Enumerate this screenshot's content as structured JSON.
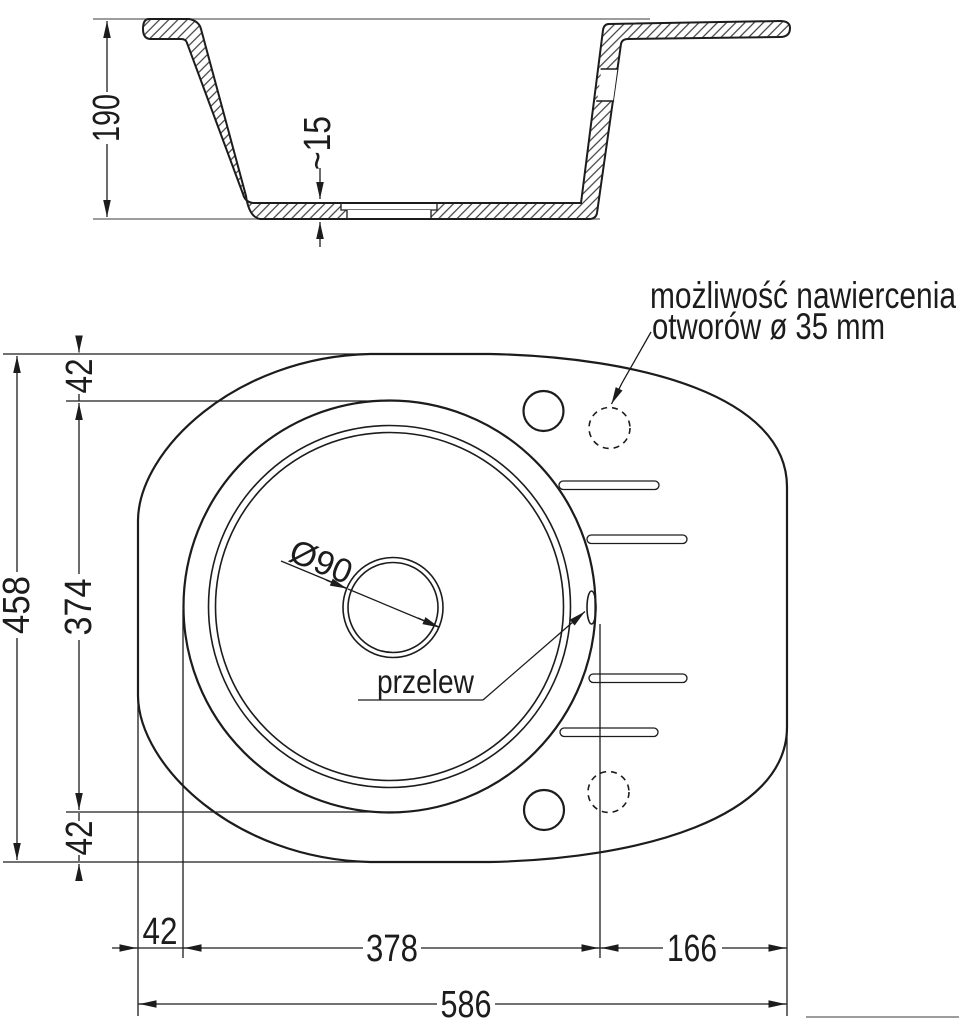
{
  "section": {
    "depth_label": "190",
    "recess_label": "~15"
  },
  "plan": {
    "left_dims": {
      "overall": "458",
      "offset_top": "42",
      "bowl": "374",
      "offset_bottom": "42"
    },
    "bottom_dims": {
      "offset_left": "42",
      "bowl": "378",
      "drainer": "166",
      "overall": "586"
    },
    "drain_label": "Ø90",
    "overflow_label": "przelew",
    "note_line1": "możliwość nawiercenia",
    "note_line2": "otworów ø 35 mm"
  },
  "colors": {
    "line": "#1c1c1c",
    "reference": "#7d7d7d",
    "background": "#ffffff"
  }
}
